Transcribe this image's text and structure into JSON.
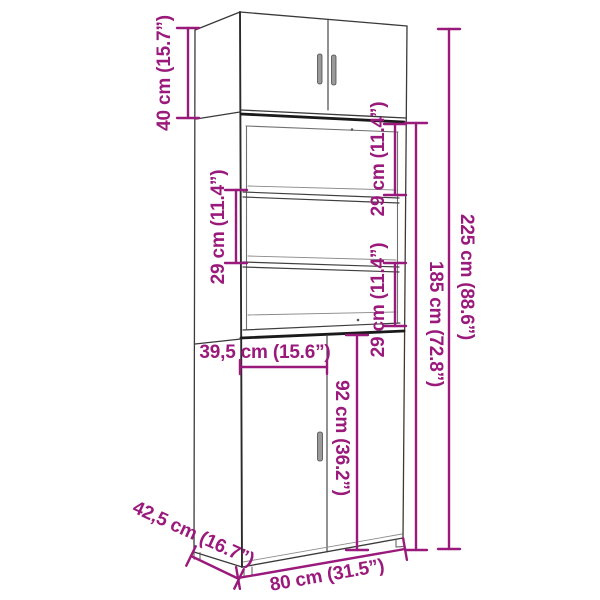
{
  "diagram": {
    "title": "highboard-cabinet-dimension-diagram",
    "colors": {
      "accent": "#9A1A7C",
      "line": "#3A3A3A",
      "line_dark": "#1A1A1A",
      "line_light": "#707070",
      "back_edge": "#8A8A8A",
      "handle": "#9A9A9A",
      "background": "#FFFFFF"
    },
    "dims": {
      "top_section_height": "40 cm (15.7”)",
      "compartment_left": "29 cm (11.4”)",
      "compartment_right_upper": "29 cm (11.4”)",
      "compartment_right_lower": "29 cm (11.4”)",
      "total_height": "225 cm (88.6”)",
      "body_height": "185 cm (72.8”)",
      "left_door_width": "39,5 cm (15.6”)",
      "lower_door_height": "92 cm (36.2”)",
      "depth": "42,5 cm (16.7”)",
      "total_width": "80 cm (31.5”)"
    }
  }
}
